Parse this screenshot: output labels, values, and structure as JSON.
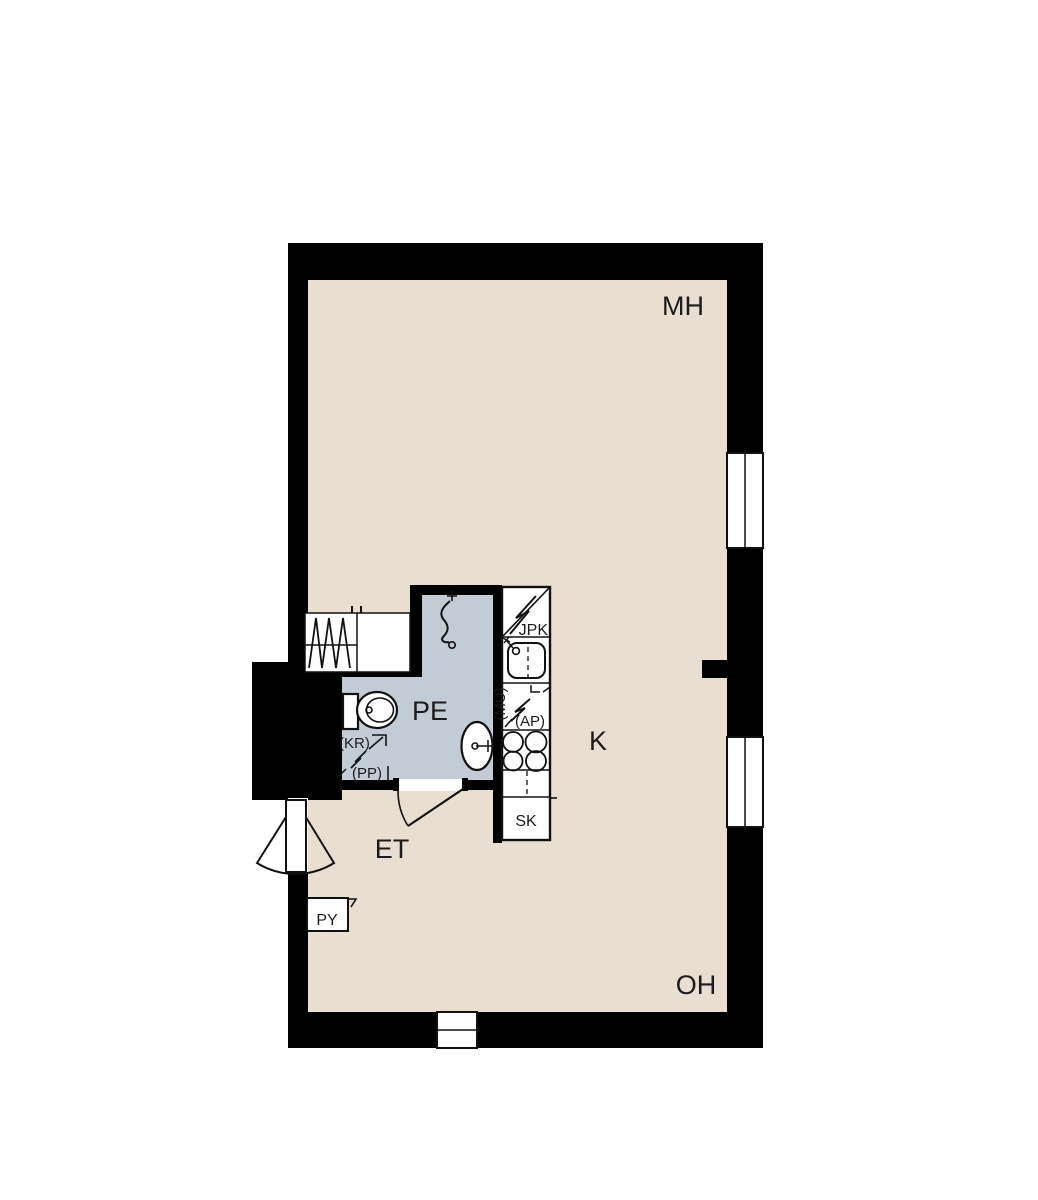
{
  "plan": {
    "title": "apartment-floor-plan",
    "colors": {
      "wall": "#000000",
      "floor": "#e8ded1",
      "wet_floor": "#c3cbd5",
      "background": "#ffffff",
      "line": "#111111"
    },
    "rooms": {
      "bedroom": "MH",
      "kitchen": "K",
      "bathroom": "PE",
      "hallway": "ET",
      "living_room": "OH"
    },
    "fixtures": {
      "fridge_freezer": "JPK",
      "microwave_reservation": "(MU)",
      "dishwasher_reservation": "(AP)",
      "cleaning_closet": "SK",
      "towel_dryer_reservation": "(KR)",
      "washing_machine_reservation": "(PP)",
      "laundry_box": "PY"
    }
  }
}
